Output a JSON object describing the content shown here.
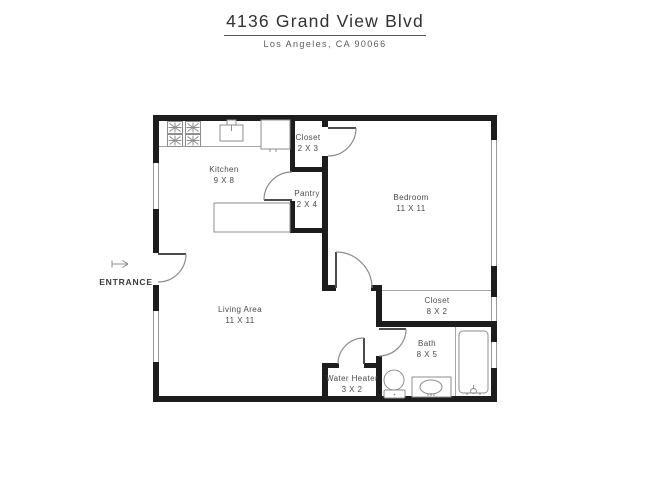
{
  "header": {
    "title": "4136 Grand View Blvd",
    "subtitle": "Los Angeles, CA 90066"
  },
  "entrance": {
    "label": "ENTRANCE"
  },
  "rooms": {
    "kitchen": {
      "name": "Kitchen",
      "dims": "9 X 8"
    },
    "closet_entry": {
      "name": "Closet",
      "dims": "2 X 3"
    },
    "pantry": {
      "name": "Pantry",
      "dims": "2 X 4"
    },
    "bedroom": {
      "name": "Bedroom",
      "dims": "11 X 11"
    },
    "living_area": {
      "name": "Living Area",
      "dims": "11 X 11"
    },
    "bedroom_closet": {
      "name": "Closet",
      "dims": "8 X 2"
    },
    "bath": {
      "name": "Bath",
      "dims": "8 X 5"
    },
    "water_heater": {
      "name": "Water Heater",
      "dims": "3 X 2"
    }
  },
  "icons": {
    "entrance_arrow": "right-arrow",
    "fixtures": [
      "stove-burners",
      "kitchen-sink",
      "refrigerator",
      "kitchen-island",
      "toilet",
      "vanity-sink",
      "bathtub"
    ]
  },
  "colors": {
    "wall": "#1d1d1d",
    "thin_line": "#9a9a9a",
    "label_text": "#4a4a4a",
    "title_text": "#313131",
    "background": "#ffffff"
  }
}
